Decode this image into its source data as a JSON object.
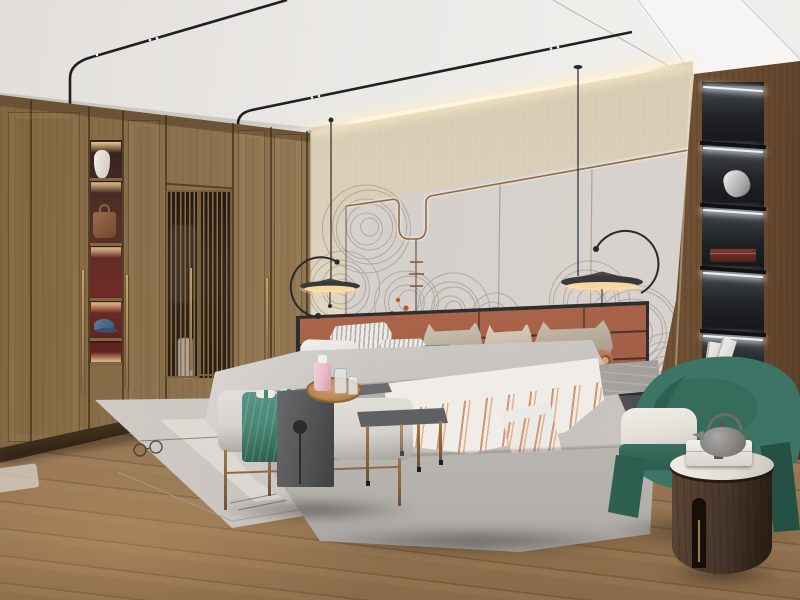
{
  "scene": {
    "type": "photorealistic interior render",
    "subject": "modern wood-and-terracotta bedroom with wardrobe, accent wall mural, pendant lamps, upholstered bed, bench group, display shelf and green armchair",
    "objects": [
      "ceiling-track-lights",
      "wardrobe",
      "display-niche",
      "vase",
      "handbag",
      "cap",
      "slatted-screen-doors",
      "led-cove-lighting",
      "accent-wall-panels",
      "wall-mural",
      "red-foliage",
      "pendant-lamp-left",
      "pendant-lamp-right",
      "leather-headboard",
      "bed",
      "pillows",
      "teal-lumbar-pillow",
      "bolster-pillow",
      "gray-blanket",
      "striped-throw",
      "nightstand-left",
      "ceramic-gourd-vase",
      "nightstand-right",
      "lantern-ornament",
      "display-shelf-column",
      "sculpture",
      "keepsake-box",
      "books",
      "bench",
      "teal-throw",
      "waterfall-console",
      "wooden-tray",
      "perfume-bottles",
      "ottoman-cushion",
      "metal-side-table",
      "area-rug",
      "pine-cones",
      "armchair",
      "seat-cushion",
      "round-side-table",
      "teapot",
      "marble-box",
      "wood-floor"
    ],
    "mural_clusters": [
      [
        368,
        228,
        44
      ],
      [
        342,
        288,
        36
      ],
      [
        408,
        302,
        32
      ],
      [
        452,
        310,
        36
      ],
      [
        494,
        318,
        24
      ],
      [
        588,
        302,
        40
      ],
      [
        634,
        332,
        48
      ],
      [
        600,
        374,
        30
      ],
      [
        668,
        374,
        40
      ],
      [
        648,
        414,
        32
      ]
    ]
  },
  "palette": {
    "ceiling": "#e8e5e1",
    "ceiling_bright": "#f6f5f3",
    "cove_glow": "#fff4d8",
    "panel_wall": "#d9d4cf",
    "trim_bronze": "#8d6b4e",
    "mural_stroke": "#8a837c",
    "mural_red": "#c8502e",
    "wardrobe_wood": "#8f7450",
    "niche_back_red": "#6e2b26",
    "warm_light": "#ffd9a0",
    "column_wood": "#7a5c3d",
    "shelf_black": "#25272a",
    "shelf_led": "#eef2f5",
    "headboard_leather": "#b06a4e",
    "headboard_frame": "#2e2e30",
    "bedding_white": "#eceae7",
    "blanket_gray": "#aba8a4",
    "throw_stripe": "#d08a63",
    "accent_teal": "#4c8877",
    "bench_fabric": "#d6d3cf",
    "table_dark_gray": "#505254",
    "tray_wood": "#b9854f",
    "bottle_pink": "#e9b9c8",
    "chair_green": "#3c7565",
    "chair_green_dark": "#2c5d4f",
    "cushion_white": "#e2ded7",
    "side_table_wood": "#46352a",
    "marble_top": "#e2ded7",
    "nightstand_gray": "#4a4c51",
    "rug": "#d9d3cf",
    "rug_band_dark": "#3a3a3a",
    "floor_wood": "#8f7050",
    "pinecone_brown": "#5e4229",
    "rail_black": "#1f2022"
  }
}
